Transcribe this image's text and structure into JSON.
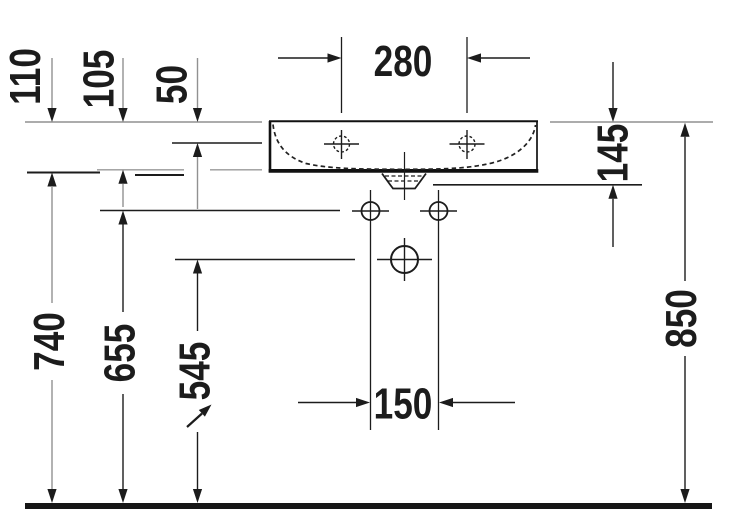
{
  "dimensions": {
    "d280": "280",
    "d110": "110",
    "d105": "105",
    "d50": "50",
    "d145": "145",
    "d740": "740",
    "d655": "655",
    "d545": "545",
    "d150": "150",
    "d850": "850"
  },
  "colors": {
    "ink": "#1c1c1c",
    "muted": "#919191",
    "floor": "#161616",
    "background": "#ffffff"
  }
}
